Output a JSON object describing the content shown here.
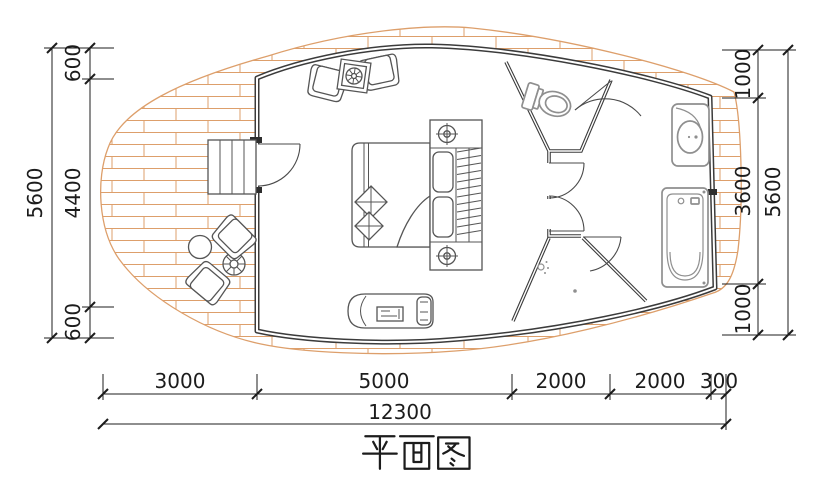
{
  "title": {
    "text": "平面图"
  },
  "dimensions": {
    "left": {
      "overall": "5600",
      "segments": [
        "600",
        "4400",
        "600"
      ]
    },
    "right": {
      "overall": "5600",
      "segments": [
        "1000",
        "3600",
        "1000"
      ]
    },
    "bottom": {
      "overall": "12300",
      "segments": [
        "3000",
        "5000",
        "2000",
        "2000",
        "300"
      ]
    }
  },
  "colors": {
    "deck_hatch": "#dd9f6b",
    "wall": "#3b3b3b",
    "fixture": "#8f8f8f",
    "furniture": "#555555",
    "dim": "#1c1c1c",
    "background": "#ffffff",
    "jamb": "#2e2e2e"
  }
}
